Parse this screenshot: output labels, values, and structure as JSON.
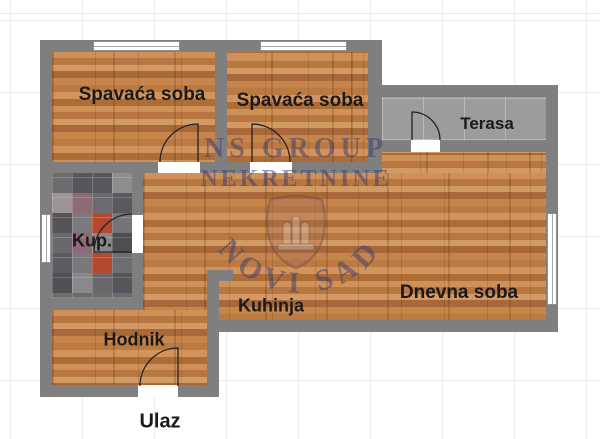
{
  "plan": {
    "rooms": [
      {
        "id": "bedroom-1",
        "label": "Spavaća soba",
        "floor": "wood"
      },
      {
        "id": "bedroom-2",
        "label": "Spavaća soba",
        "floor": "wood"
      },
      {
        "id": "terrace",
        "label": "Terasa",
        "floor": "gray-tile"
      },
      {
        "id": "bathroom",
        "label": "Kup.",
        "floor": "mosaic-tile"
      },
      {
        "id": "kitchen",
        "label": "Kuhinja",
        "floor": "wood"
      },
      {
        "id": "living-room",
        "label": "Dnevna soba",
        "floor": "wood"
      },
      {
        "id": "hallway",
        "label": "Hodnik",
        "floor": "wood"
      }
    ],
    "entrance_label": "Ulaz"
  },
  "watermark": {
    "line1": "NS GROUP",
    "line2": "NEKRETNINE",
    "arc_text": "NOVI SAD"
  },
  "colors": {
    "background": "#ffffff",
    "wall": "#7f7f7f",
    "wood_floor": "#c8854b",
    "terrace_tile": "#9c9c9e",
    "label_text": "#1a1a1a",
    "watermark_text": "#3d3d73",
    "mosaic_accent_orange": "#b3492e",
    "mosaic_accent_mauve": "#8d6a75"
  }
}
